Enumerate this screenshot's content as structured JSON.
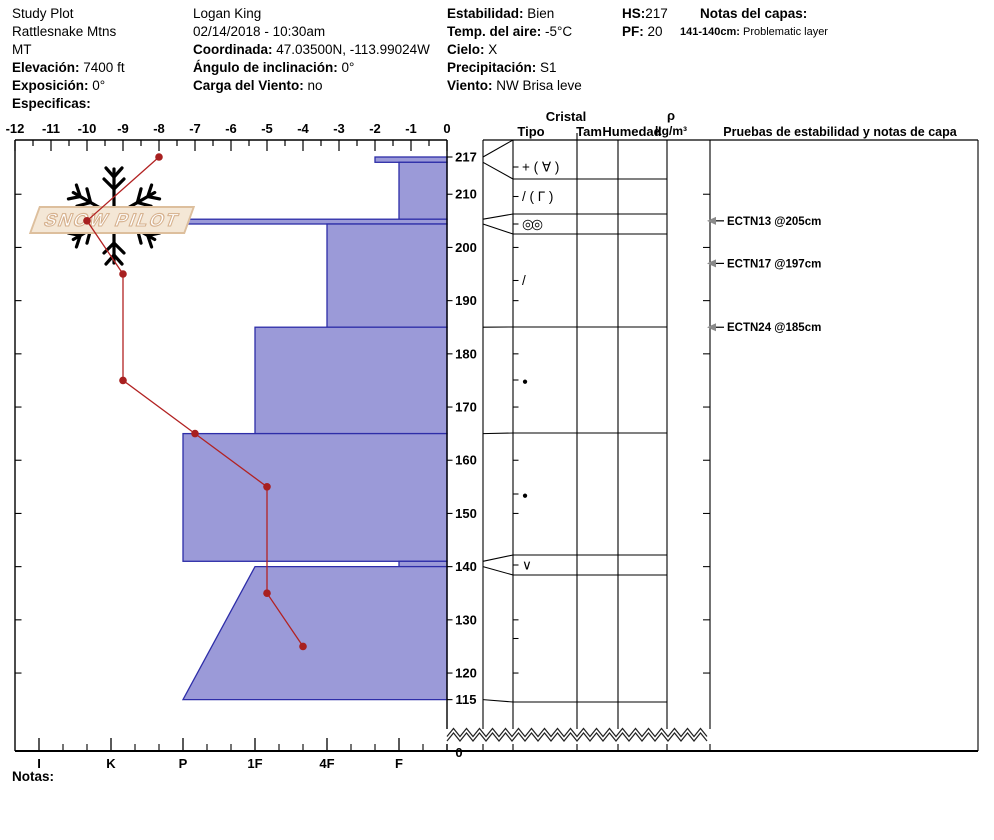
{
  "header": {
    "columns": [
      {
        "x": 12,
        "lines": [
          {
            "b": "",
            "t": "Study Plot"
          },
          {
            "b": "",
            "t": "Rattlesnake Mtns"
          },
          {
            "b": "",
            "t": "MT"
          },
          {
            "b": "Elevación:",
            "t": " 7400 ft"
          },
          {
            "b": "Exposición:",
            "t": " 0°"
          },
          {
            "b": "Especificas:",
            "t": ""
          }
        ]
      },
      {
        "x": 193,
        "lines": [
          {
            "b": "",
            "t": "Logan King"
          },
          {
            "b": "",
            "t": "02/14/2018 - 10:30am"
          },
          {
            "b": "Coordinada:",
            "t": " 47.03500N, -113.99024W"
          },
          {
            "b": "Ángulo de inclinación:",
            "t": " 0°"
          },
          {
            "b": "Carga del Viento:",
            "t": " no"
          }
        ]
      },
      {
        "x": 447,
        "lines": [
          {
            "b": "Estabilidad:",
            "t": " Bien"
          },
          {
            "b": "Temp. del aire:",
            "t": " -5°C"
          },
          {
            "b": "Cielo:",
            "t": " X"
          },
          {
            "b": "Precipitación:",
            "t": " S1"
          },
          {
            "b": "Viento:",
            "t": "  NW Brisa leve"
          }
        ]
      },
      {
        "x": 622,
        "lines": [
          {
            "b": "HS:",
            "t": "217"
          },
          {
            "b": "PF:",
            "t": " 20"
          }
        ]
      },
      {
        "x": 700,
        "lines": [
          {
            "b": "Notas del capas:",
            "t": ""
          },
          {
            "b": "141-140cm:",
            "t": " Problematic layer",
            "small": true,
            "x": 680
          }
        ]
      }
    ]
  },
  "watermark": {
    "text": "SNOW PILOT"
  },
  "notes_label": "Notas:",
  "chart_data": {
    "type": "snow-profile",
    "title": "Snow profile hardness / temperature plot",
    "temperature_axis": {
      "unit": "°C",
      "min": -12,
      "max": 0,
      "tick_step": 1,
      "labels": [
        -12,
        -11,
        -10,
        -9,
        -8,
        -7,
        -6,
        -5,
        -4,
        -3,
        -2,
        -1,
        0
      ]
    },
    "depth_axis": {
      "unit": "cm",
      "surface": 217,
      "bottom": 115,
      "labels": [
        217,
        210,
        200,
        190,
        180,
        170,
        160,
        150,
        140,
        130,
        120,
        115
      ],
      "break_label": "0"
    },
    "hardness_axis": {
      "labels": [
        "I",
        "K",
        "P",
        "1F",
        "4F",
        "F"
      ]
    },
    "temperature_profile": [
      {
        "depth": 217,
        "temp": -8
      },
      {
        "depth": 205,
        "temp": -10
      },
      {
        "depth": 195,
        "temp": -9
      },
      {
        "depth": 175,
        "temp": -9
      },
      {
        "depth": 165,
        "temp": -7
      },
      {
        "depth": 155,
        "temp": -5
      },
      {
        "depth": 135,
        "temp": -5
      },
      {
        "depth": 125,
        "temp": -4
      }
    ],
    "layers": [
      {
        "top": 217,
        "bottom": 216,
        "hardness": "F+",
        "grain": "+ ( ∀ )"
      },
      {
        "top": 216,
        "bottom": 205.3,
        "hardness": "F",
        "grain": "/ ( Γ )"
      },
      {
        "top": 205.3,
        "bottom": 204.4,
        "hardness": "P",
        "grain": "◎◎"
      },
      {
        "top": 204.4,
        "bottom": 185,
        "hardness": "4F",
        "grain": "/"
      },
      {
        "top": 185,
        "bottom": 165,
        "hardness": "1F",
        "grain": "●"
      },
      {
        "top": 165,
        "bottom": 141,
        "hardness": "P",
        "grain": "●"
      },
      {
        "top": 141,
        "bottom": 140,
        "hardness": "F",
        "grain": "∨"
      },
      {
        "top": 140,
        "bottom": 115,
        "hardness_top": "1F",
        "hardness_bottom": "P",
        "grain": ""
      }
    ],
    "stability_tests": [
      {
        "label": "ECTN13 @205cm",
        "depth": 205
      },
      {
        "label": "ECTN17 @197cm",
        "depth": 197
      },
      {
        "label": "ECTN24 @185cm",
        "depth": 185
      }
    ],
    "colors": {
      "bar_fill": "#9b9ad8",
      "bar_border": "#2d2da8",
      "temp_line": "#b22222",
      "temp_point": "#a82020",
      "watermark_flake": "#c7d2e0",
      "watermark_text": "#d6b18e",
      "arrow_gray": "#8a8a8a"
    }
  },
  "layer_table": {
    "group_header": "Cristal",
    "col_tipo": "Tipo",
    "col_tam": "Tam",
    "col_humedad": "Humedad",
    "density_header_top": "ρ",
    "density_header_bottom": "kg/m³",
    "tests_header": "Pruebas de estabilidad y notas de capa"
  }
}
